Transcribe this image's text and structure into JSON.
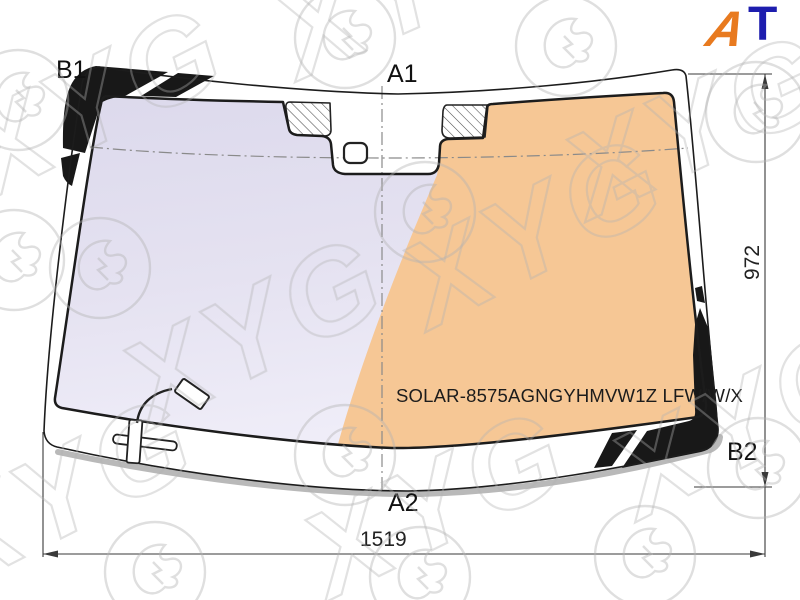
{
  "diagram": {
    "markers": {
      "top_left": "B1",
      "top_center": "A1",
      "bottom_center": "A2",
      "right": "B2"
    },
    "dimensions": {
      "height_mm": "972",
      "width_mm": "1519"
    },
    "part_number": "SOLAR-8575AGNGYHMVW1Z LFW/W/X"
  },
  "logo": {
    "letter_a": "A",
    "letter_t": "T",
    "a_color": "#e87a1f",
    "t_color": "#1d1dae"
  },
  "watermark": {
    "text": "XYG"
  },
  "colors": {
    "tint_left": "#e2dfef",
    "tint_right": "#f6c795",
    "frit_black": "#181818",
    "shadow_gray": "#b9b9b9",
    "line_dark": "#1c1c1c"
  }
}
